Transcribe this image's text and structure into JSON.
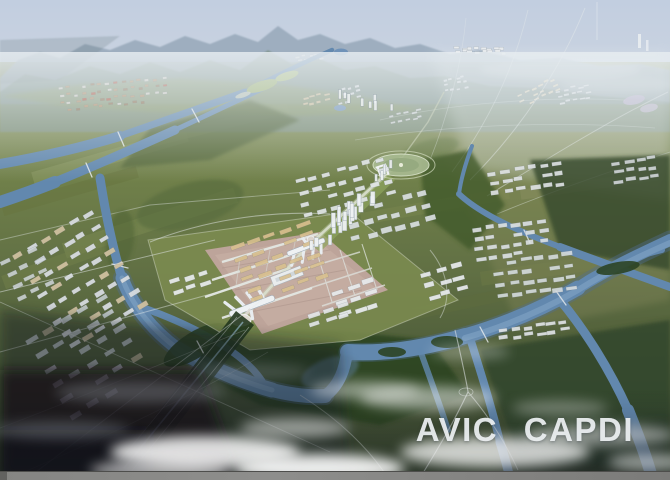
{
  "scene": {
    "type": "aerial-masterplan-rendering",
    "watermark": "AVIC CAPDI",
    "description": "Bird's-eye architectural rendering of a planned airport city: central axis with twin star-shaped terminals and runways, surrounding building clusters, braided rivers, farmland plains, hazy mountains on the horizon and low clouds in the foreground",
    "colors": {
      "sky": "#c5d0e0",
      "mountains": "#8fa3b5",
      "farmland": "#6f7d48",
      "river": "#6288ae",
      "forest": "#2f4526",
      "airport_apron": "#bfa69c",
      "buildings": "#e2e6e8",
      "tan_buildings": "#d9c08f",
      "clouds": "#ffffff",
      "watermark_text": "#eef1f3",
      "bottom_bar": "#828280"
    }
  }
}
